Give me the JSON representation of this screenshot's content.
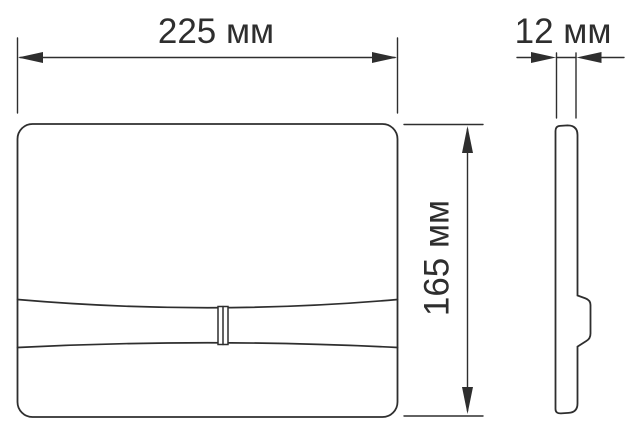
{
  "drawing": {
    "background_color": "#ffffff",
    "line_color": "#2e2e2e",
    "dimension_labels": {
      "width": "225 мм",
      "thickness": "12 мм",
      "height": "165 мм"
    },
    "dimension_values": {
      "width_mm": 225,
      "thickness_mm": 12,
      "height_mm": 165,
      "unit": "мм"
    }
  }
}
